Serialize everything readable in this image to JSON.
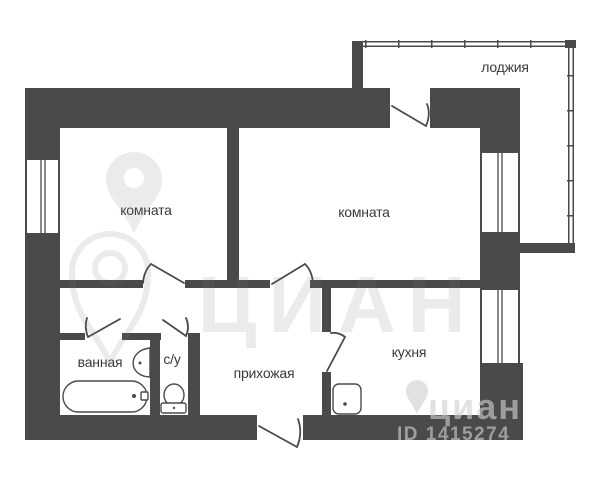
{
  "image": {
    "type": "apartment-floor-plan"
  },
  "rooms": {
    "room1": "комната",
    "room2": "комната",
    "loggia": "лоджия",
    "bathroom": "ванная",
    "wc": "с/у",
    "hallway": "прихожая",
    "kitchen": "кухня"
  },
  "watermark": {
    "brand_large": "ЦИАН",
    "brand_small": "циан",
    "listing_id": "ID 1415274"
  },
  "colors": {
    "wall": "#4a4a4a",
    "background": "#ffffff",
    "label_text": "#3a3a3a",
    "watermark_gray": "#7a7a7a"
  }
}
